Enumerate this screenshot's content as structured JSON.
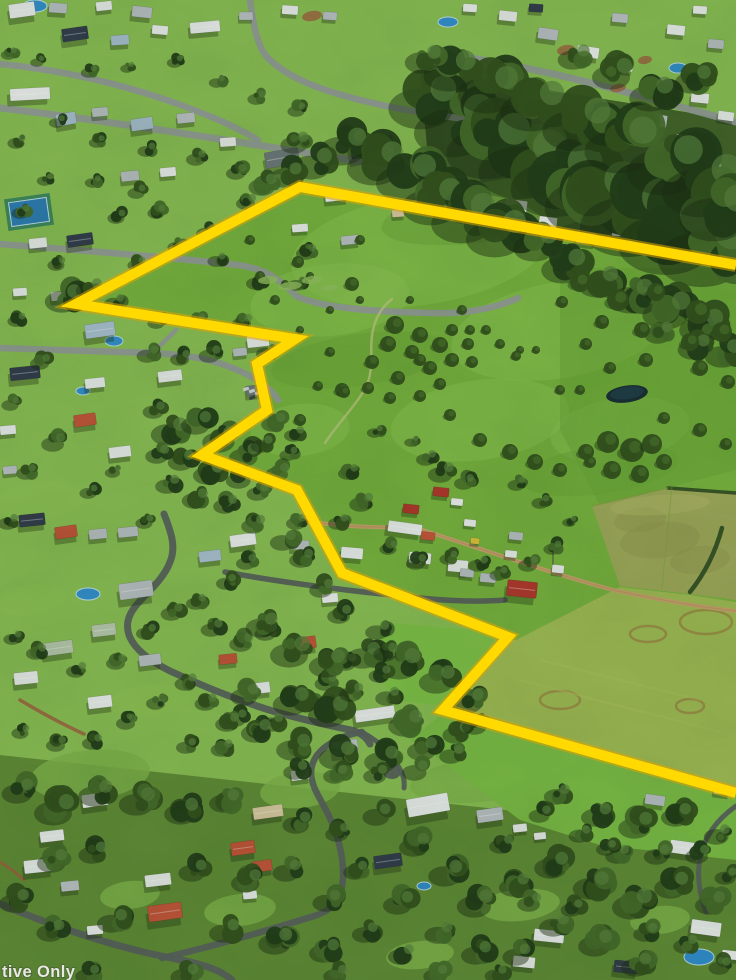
{
  "meta": {
    "type": "aerial-photograph",
    "width": 736,
    "height": 980,
    "description": "Oblique aerial photo of a semi-rural township: housing estates at top and left, dense eucalypt tree belts, an open green pasture acreage outlined with a yellow property-boundary overlay, a farm building cluster with a dirt driveway, olive paddocks to the right, and tree-lined streets with houses across the bottom."
  },
  "watermark": {
    "text": "tive Only",
    "color": "#efefec"
  },
  "boundary_overlay": {
    "label": "property-boundary",
    "stroke_color": "#ffd900",
    "halo_color": "#dfa400",
    "stroke_width": 10,
    "points": "736,265 300,187 76,304 295,339 257,364 267,410 202,455 297,490 342,573 508,637 443,710 736,793"
  },
  "scene": {
    "palette": {
      "grass_suburb": "#8abf55",
      "pasture": "#78b440",
      "pasture_light": "#8cc653",
      "pasture_dark": "#69a338",
      "field_olive": "#a0aa5c",
      "field_olive_dark": "#8f9a4e",
      "field_olive_light": "#b0b968",
      "field_yellow": "#9fbc55",
      "field_yellow_light": "#b2c465",
      "paddock_bright": "#7fc24a",
      "paddock_below": "#7cbd47",
      "forest_floor": "#3c5c28",
      "bottom_floor": "#5d8a36",
      "lawn_light": "#7fb54c",
      "canopy_dark": "#24401a",
      "canopy_mid": "#35541f",
      "canopy_light": "#476f2c",
      "canopy_hi": "#5a8440",
      "tree_shadow": "#1c3114",
      "scrub": "#95c162",
      "road": "#949c99",
      "road_dark": "#5a635e",
      "dirt_road": "#c7a46f",
      "dirt_road_dark": "#b8945c",
      "red_dirt": "#9d6440",
      "trail": "#b9c87e",
      "roof_white": "#e9edec",
      "roof_gray": "#b9c1c4",
      "roof_navy": "#33404e",
      "roof_blue": "#a8c0d0",
      "roof_terracotta": "#c2573b",
      "roof_red": "#b03a2e",
      "roof_sage": "#b7c9ae",
      "roof_dark": "#6e7a7c",
      "roof_beige": "#d8c9a3",
      "roof_yellow": "#d8c23a",
      "pool_blue": "#2f8fd4",
      "pool_rim": "#bfe0ef",
      "court_blue": "#2e7fb5",
      "court_green": "#3f8a5f",
      "pond": "#1b3038",
      "pond_inner": "#203f47",
      "hedge": "#2f4d22",
      "ring_brown": "#9a6a3e",
      "car_light": "#cfd4d6",
      "car_dark": "#3f464b",
      "pole": "#3a3a3a"
    }
  }
}
